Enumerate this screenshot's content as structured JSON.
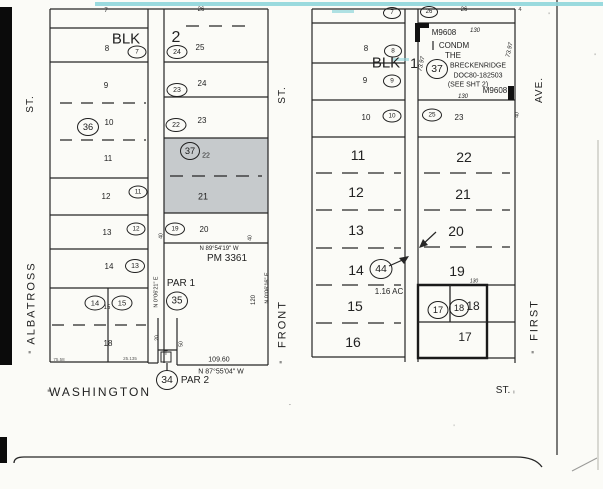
{
  "map": {
    "colors": {
      "ink": "#222222",
      "paper": "#fbfbf7",
      "lot_shade": "#c6cacc",
      "cyan_scan_line": "#8fd6da",
      "edge_bar": "#0b0b0b"
    },
    "street_labels": [
      {
        "id": "albatross-st-suffix-label",
        "t": "ST.",
        "x": 31,
        "y": 104,
        "s": 10,
        "r": -90,
        "ls": 1
      },
      {
        "id": "albatross-street-label",
        "t": "ALBATROSS",
        "x": 32,
        "y": 303,
        "s": 11,
        "r": -90,
        "ls": 2
      },
      {
        "id": "albatross-section-tick",
        "t": "≡",
        "x": 31,
        "y": 352,
        "s": 5,
        "r": -90
      },
      {
        "id": "front-st-suffix-label",
        "t": "ST.",
        "x": 283,
        "y": 95,
        "s": 10,
        "r": -90,
        "ls": 1
      },
      {
        "id": "front-street-label",
        "t": "FRONT",
        "x": 283,
        "y": 324,
        "s": 11,
        "r": -90,
        "ls": 2
      },
      {
        "id": "front-section-tick",
        "t": "≡",
        "x": 282,
        "y": 362,
        "s": 5,
        "r": -90
      },
      {
        "id": "first-ave-suffix-label",
        "t": "AVE.",
        "x": 540,
        "y": 90,
        "s": 10,
        "r": -90,
        "ls": 1
      },
      {
        "id": "first-street-label",
        "t": "FIRST",
        "x": 535,
        "y": 320,
        "s": 11,
        "r": -90,
        "ls": 2
      },
      {
        "id": "first-section-tick",
        "t": "≡",
        "x": 534,
        "y": 352,
        "s": 5,
        "r": -90
      },
      {
        "id": "washington-street-label",
        "t": "WASHINGTON",
        "x": 100,
        "y": 392,
        "s": 12,
        "ls": 2
      },
      {
        "id": "washington-section-tick",
        "t": "≡",
        "x": 49,
        "y": 392,
        "s": 5
      },
      {
        "id": "washington-st-suffix-label",
        "t": "ST.",
        "x": 503,
        "y": 391,
        "s": 10
      },
      {
        "id": "washington-st-tick",
        "t": "ı",
        "x": 514,
        "y": 393,
        "s": 5
      }
    ],
    "block_labels": [
      {
        "id": "blk2-label",
        "t": "BLK",
        "x": 126,
        "y": 39,
        "s": 15
      },
      {
        "id": "blk2-number",
        "t": "2",
        "x": 176,
        "y": 38,
        "s": 16
      },
      {
        "id": "blk1-label",
        "t": "BLK",
        "x": 386,
        "y": 63,
        "s": 15
      },
      {
        "id": "blk1-number",
        "t": "1",
        "x": 414,
        "y": 63,
        "s": 14
      }
    ],
    "lot_numbers": [
      {
        "id": "blk2-lot-7",
        "t": "7",
        "x": 106,
        "y": 11,
        "s": 6
      },
      {
        "id": "blk2-lot-8",
        "t": "8",
        "x": 107,
        "y": 49,
        "s": 8
      },
      {
        "id": "blk2-lot-9",
        "t": "9",
        "x": 106,
        "y": 86,
        "s": 8
      },
      {
        "id": "blk2-lot-10",
        "t": "10",
        "x": 109,
        "y": 123,
        "s": 8
      },
      {
        "id": "blk2-lot-11",
        "t": "11",
        "x": 108,
        "y": 159,
        "s": 8
      },
      {
        "id": "blk2-lot-12",
        "t": "12",
        "x": 106,
        "y": 197,
        "s": 8
      },
      {
        "id": "blk2-lot-13",
        "t": "13",
        "x": 107,
        "y": 233,
        "s": 8
      },
      {
        "id": "blk2-lot-14",
        "t": "14",
        "x": 109,
        "y": 267,
        "s": 8
      },
      {
        "id": "blk2-lot-15",
        "t": "15",
        "x": 107,
        "y": 308,
        "s": 6
      },
      {
        "id": "blk2-lot-18",
        "t": "18",
        "x": 108,
        "y": 344,
        "s": 8
      },
      {
        "id": "blk2-lot-26",
        "t": "26",
        "x": 201,
        "y": 10,
        "s": 6
      },
      {
        "id": "blk2-lot-25",
        "t": "25",
        "x": 200,
        "y": 48,
        "s": 8
      },
      {
        "id": "blk2-lot-24",
        "t": "24",
        "x": 202,
        "y": 84,
        "s": 8
      },
      {
        "id": "blk2-lot-23",
        "t": "23",
        "x": 202,
        "y": 121,
        "s": 8
      },
      {
        "id": "blk2-lot-22",
        "t": "22",
        "x": 206,
        "y": 156,
        "s": 7
      },
      {
        "id": "blk2-lot-21",
        "t": "21",
        "x": 203,
        "y": 197,
        "s": 9
      },
      {
        "id": "blk2-lot-20",
        "t": "20",
        "x": 204,
        "y": 230,
        "s": 8
      },
      {
        "id": "blk1-lot-8",
        "t": "8",
        "x": 366,
        "y": 49,
        "s": 8
      },
      {
        "id": "blk1-lot-9",
        "t": "9",
        "x": 365,
        "y": 81,
        "s": 8
      },
      {
        "id": "blk1-lot-10",
        "t": "10",
        "x": 366,
        "y": 118,
        "s": 8
      },
      {
        "id": "blk1-lot-11",
        "t": "11",
        "x": 358,
        "y": 155,
        "s": 14
      },
      {
        "id": "blk1-lot-12",
        "t": "12",
        "x": 356,
        "y": 192,
        "s": 14
      },
      {
        "id": "blk1-lot-13",
        "t": "13",
        "x": 356,
        "y": 230,
        "s": 14
      },
      {
        "id": "blk1-lot-14",
        "t": "14",
        "x": 356,
        "y": 270,
        "s": 14
      },
      {
        "id": "blk1-lot-15",
        "t": "15",
        "x": 355,
        "y": 306,
        "s": 14
      },
      {
        "id": "blk1-lot-16",
        "t": "16",
        "x": 353,
        "y": 342,
        "s": 14
      },
      {
        "id": "blk1-lot-26",
        "t": "26",
        "x": 464,
        "y": 10,
        "s": 6
      },
      {
        "id": "blk1-lot-23",
        "t": "23",
        "x": 459,
        "y": 118,
        "s": 8
      },
      {
        "id": "blk1-lot-22",
        "t": "22",
        "x": 464,
        "y": 157,
        "s": 14
      },
      {
        "id": "blk1-lot-21",
        "t": "21",
        "x": 463,
        "y": 194,
        "s": 14
      },
      {
        "id": "blk1-lot-20",
        "t": "20",
        "x": 456,
        "y": 231,
        "s": 14
      },
      {
        "id": "blk1-lot-19",
        "t": "19",
        "x": 457,
        "y": 271,
        "s": 14
      },
      {
        "id": "blk1-lot-18",
        "t": "18",
        "x": 473,
        "y": 306,
        "s": 12
      },
      {
        "id": "blk1-lot-17",
        "t": "17",
        "x": 465,
        "y": 337,
        "s": 12
      }
    ],
    "parcel_circles": [
      {
        "id": "parcel-circle-7-blk2",
        "n": "7",
        "x": 137,
        "y": 52,
        "w": 17,
        "h": 11
      },
      {
        "id": "parcel-circle-24",
        "n": "24",
        "x": 177,
        "y": 52,
        "w": 19,
        "h": 12
      },
      {
        "id": "parcel-circle-23",
        "n": "23",
        "x": 177,
        "y": 90,
        "w": 19,
        "h": 12
      },
      {
        "id": "parcel-circle-22",
        "n": "22",
        "x": 176,
        "y": 125,
        "w": 19,
        "h": 12
      },
      {
        "id": "parcel-circle-36",
        "n": "36",
        "x": 88,
        "y": 127,
        "w": 20,
        "h": 16
      },
      {
        "id": "parcel-circle-37-blk2",
        "n": "37",
        "x": 190,
        "y": 151,
        "w": 18,
        "h": 16
      },
      {
        "id": "parcel-circle-11",
        "n": "11",
        "x": 138,
        "y": 192,
        "w": 17,
        "h": 11
      },
      {
        "id": "parcel-circle-12",
        "n": "12",
        "x": 136,
        "y": 229,
        "w": 17,
        "h": 11
      },
      {
        "id": "parcel-circle-19",
        "n": "19",
        "x": 175,
        "y": 229,
        "w": 18,
        "h": 11
      },
      {
        "id": "parcel-circle-13",
        "n": "13",
        "x": 135,
        "y": 266,
        "w": 18,
        "h": 12
      },
      {
        "id": "parcel-circle-14",
        "n": "14",
        "x": 95,
        "y": 303,
        "w": 19,
        "h": 13
      },
      {
        "id": "parcel-circle-15",
        "n": "15",
        "x": 122,
        "y": 303,
        "w": 19,
        "h": 13
      },
      {
        "id": "parcel-circle-35",
        "n": "35",
        "x": 177,
        "y": 301,
        "w": 20,
        "h": 17
      },
      {
        "id": "parcel-circle-34",
        "n": "34",
        "x": 167,
        "y": 380,
        "w": 20,
        "h": 18
      },
      {
        "id": "parcel-circle-7-blk1",
        "n": "7",
        "x": 392,
        "y": 13,
        "w": 16,
        "h": 10
      },
      {
        "id": "parcel-circle-26",
        "n": "26",
        "x": 429,
        "y": 12,
        "w": 16,
        "h": 10
      },
      {
        "id": "parcel-circle-8",
        "n": "8",
        "x": 393,
        "y": 51,
        "w": 16,
        "h": 11
      },
      {
        "id": "parcel-circle-9",
        "n": "9",
        "x": 392,
        "y": 81,
        "w": 16,
        "h": 11
      },
      {
        "id": "parcel-circle-10",
        "n": "10",
        "x": 392,
        "y": 116,
        "w": 17,
        "h": 11
      },
      {
        "id": "parcel-circle-25",
        "n": "25",
        "x": 432,
        "y": 115,
        "w": 18,
        "h": 11
      },
      {
        "id": "parcel-circle-37-condo",
        "n": "37",
        "x": 437,
        "y": 69,
        "w": 20,
        "h": 18
      },
      {
        "id": "parcel-circle-44",
        "n": "44",
        "x": 381,
        "y": 269,
        "w": 21,
        "h": 18
      },
      {
        "id": "parcel-circle-17",
        "n": "17",
        "x": 438,
        "y": 310,
        "w": 19,
        "h": 16
      },
      {
        "id": "parcel-circle-18",
        "n": "18",
        "x": 459,
        "y": 308,
        "w": 18,
        "h": 16
      }
    ],
    "annotations": [
      {
        "id": "condo-map-number-top",
        "t": "M9608",
        "x": 444,
        "y": 33,
        "s": 8
      },
      {
        "id": "condo-dim-130-top",
        "t": "130",
        "x": 475,
        "y": 31,
        "s": 6,
        "it": 1
      },
      {
        "id": "condo-text-1",
        "t": "CONDM",
        "x": 454,
        "y": 46,
        "s": 8
      },
      {
        "id": "condo-text-2",
        "t": "THE",
        "x": 453,
        "y": 56,
        "s": 8
      },
      {
        "id": "condo-text-3",
        "t": "BRECKENRIDGE",
        "x": 478,
        "y": 66,
        "s": 7
      },
      {
        "id": "condo-text-4",
        "t": "DOC80-182503",
        "x": 478,
        "y": 76,
        "s": 7
      },
      {
        "id": "condo-text-5",
        "t": "(SEE SHT 2)",
        "x": 468,
        "y": 85,
        "s": 7
      },
      {
        "id": "condo-map-number-bottom",
        "t": "M9608",
        "x": 495,
        "y": 91,
        "s": 8
      },
      {
        "id": "condo-dim-130-bottom",
        "t": "130",
        "x": 463,
        "y": 97,
        "s": 6,
        "it": 1
      },
      {
        "id": "dim-130-lot18",
        "t": "130",
        "x": 474,
        "y": 282,
        "s": 5,
        "it": 1
      },
      {
        "id": "condo-dim-7397-west",
        "t": "73.97",
        "x": 422,
        "y": 64,
        "s": 6,
        "r": -78,
        "it": 1
      },
      {
        "id": "condo-dim-7397-east",
        "t": "73.97",
        "x": 510,
        "y": 50,
        "s": 6,
        "r": -78,
        "it": 1
      },
      {
        "id": "acreage-label",
        "t": "1.16 AC",
        "x": 389,
        "y": 292,
        "s": 8
      },
      {
        "id": "parcel-map-number",
        "t": "PM 3361",
        "x": 227,
        "y": 259,
        "s": 10
      },
      {
        "id": "parcel-1-label",
        "t": "PAR 1",
        "x": 181,
        "y": 284,
        "s": 10
      },
      {
        "id": "parcel-2-label",
        "t": "PAR 2",
        "x": 195,
        "y": 381,
        "s": 10
      },
      {
        "id": "bearing-north-line",
        "t": "N 89°54'19\" W",
        "x": 219,
        "y": 249,
        "s": 6
      },
      {
        "id": "bearing-south-line",
        "t": "N 87°55'04\" W",
        "x": 221,
        "y": 372,
        "s": 7
      },
      {
        "id": "dim-10960",
        "t": "109.60",
        "x": 219,
        "y": 360,
        "s": 7
      },
      {
        "id": "bearing-west-line",
        "t": "N 0°06'21\" E",
        "x": 157,
        "y": 292,
        "s": 5.5,
        "r": -90
      },
      {
        "id": "bearing-east-line",
        "t": "N 0°06'16\" E",
        "x": 268,
        "y": 288,
        "s": 5.5,
        "r": -90
      },
      {
        "id": "dim-120",
        "t": "120",
        "x": 254,
        "y": 300,
        "s": 6,
        "r": -90
      },
      {
        "id": "dim-40-west",
        "t": "40",
        "x": 162,
        "y": 236,
        "s": 5,
        "r": -90
      },
      {
        "id": "dim-40-east",
        "t": "40",
        "x": 251,
        "y": 238,
        "s": 5,
        "r": -90
      },
      {
        "id": "dim-40-firstave",
        "t": "40",
        "x": 518,
        "y": 115,
        "s": 5,
        "r": -90
      },
      {
        "id": "dim-20-stem",
        "t": "20",
        "x": 158,
        "y": 338,
        "s": 5,
        "r": -90
      },
      {
        "id": "dim-50-stem",
        "t": "50",
        "x": 182,
        "y": 344,
        "s": 5,
        "r": -90
      },
      {
        "id": "stem-t-mark",
        "t": "T",
        "x": 166,
        "y": 354,
        "s": 6
      },
      {
        "id": "dim-7558",
        "t": "75.58",
        "x": 59,
        "y": 360,
        "s": 4.5,
        "op": 0.75
      },
      {
        "id": "dim-25135",
        "t": "25.135",
        "x": 130,
        "y": 359,
        "s": 4.5,
        "op": 0.75
      },
      {
        "id": "stray-mark-4",
        "t": "4",
        "x": 520,
        "y": 10,
        "s": 6,
        "op": 0.8
      },
      {
        "id": "stray-tick-1",
        "t": "'",
        "x": 549,
        "y": 16,
        "s": 7,
        "op": 0.7
      },
      {
        "id": "stray-tick-2",
        "t": "'",
        "x": 595,
        "y": 57,
        "s": 7,
        "op": 0.7
      },
      {
        "id": "stray-dash-1",
        "t": "-",
        "x": 290,
        "y": 405,
        "s": 7,
        "r": -20,
        "op": 0.5
      },
      {
        "id": "stray-tick-3",
        "t": "'",
        "x": 454,
        "y": 428,
        "s": 7,
        "op": 0.5
      }
    ]
  }
}
